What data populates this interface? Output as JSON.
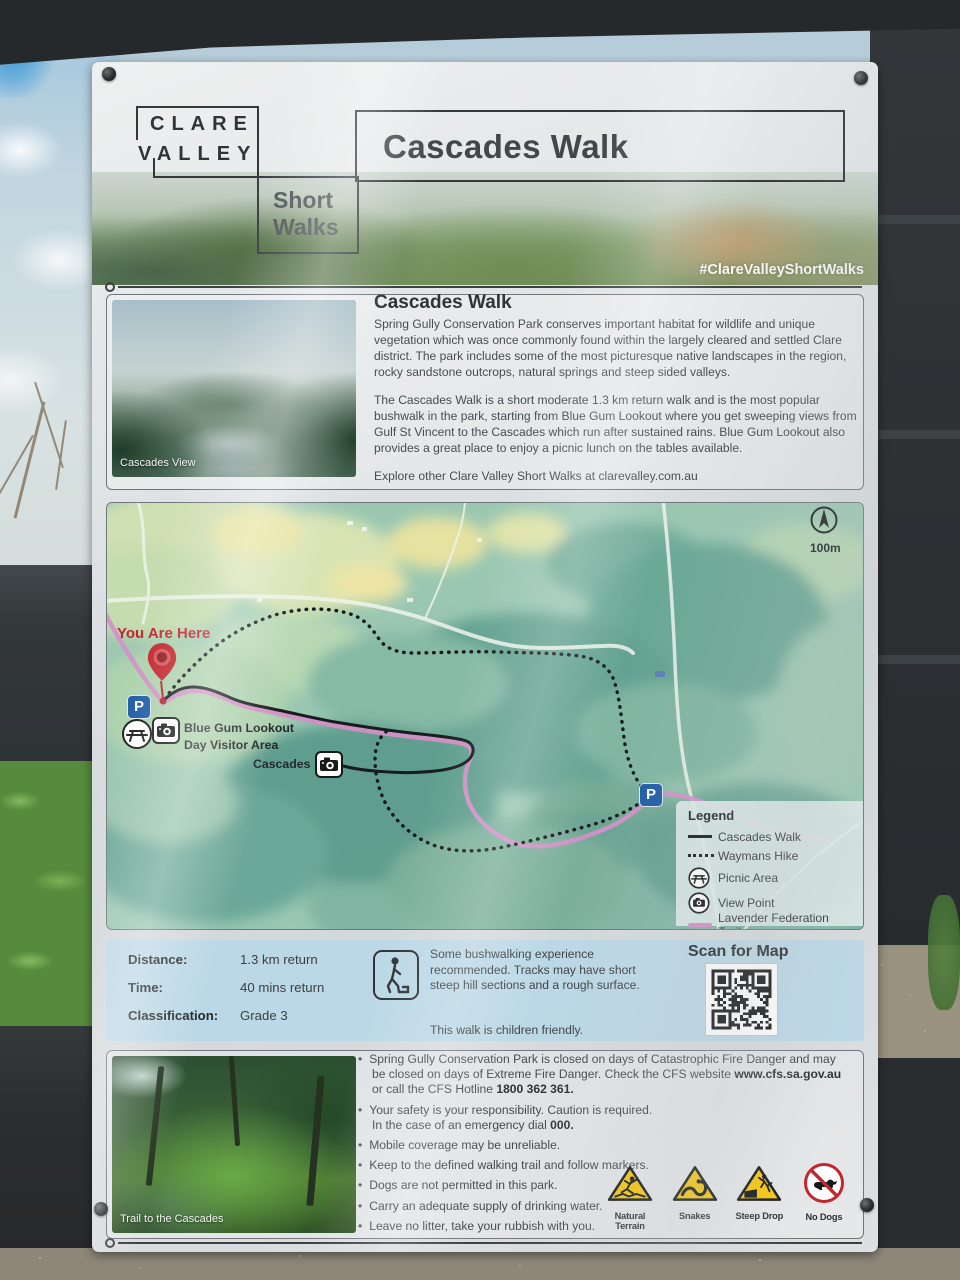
{
  "sign": {
    "brand": {
      "top": "CLARE",
      "bottom": "VALLEY"
    },
    "series": {
      "line1": "Short",
      "line2": "Walks"
    },
    "title": "Cascades Walk",
    "hashtag": "#ClareValleyShortWalks"
  },
  "about": {
    "heading": "Cascades Walk",
    "p1": "Spring Gully Conservation Park conserves important habitat for wildlife and unique vegetation which was once commonly found within the largely cleared and settled Clare district. The park includes some of the most picturesque native landscapes in the region, rocky sandstone outcrops, natural springs and steep sided valleys.",
    "p2": "The Cascades Walk is a short moderate 1.3 km return walk and is the most popular bushwalk in the park, starting from Blue Gum Lookout where you get sweeping views from Gulf St Vincent to the Cascades which run after sustained rains. Blue Gum Lookout also provides a great place to enjoy a picnic lunch on the tables available.",
    "p3": "Explore other Clare Valley Short Walks at clarevalley.com.au",
    "photo_caption": "Cascades View"
  },
  "map": {
    "you_are_here": "You Are Here",
    "scale_label": "100m",
    "parking_label": "P",
    "poi_blue_gum_line1": "Blue Gum Lookout",
    "poi_blue_gum_line2": "Day Visitor Area",
    "poi_cascades": "Cascades",
    "legend": {
      "title": "Legend",
      "items": [
        "Cascades Walk",
        "Waymans Hike",
        "Picnic Area",
        "View Point",
        "Lavender Federation Trail"
      ]
    }
  },
  "facts": {
    "rows": [
      {
        "label": "Distance:",
        "value": "1.3 km return"
      },
      {
        "label": "Time:",
        "value": "40 mins return"
      },
      {
        "label": "Classification:",
        "value": "Grade 3"
      }
    ],
    "note": "Some bushwalking experience recommended. Tracks may have short steep hill sections and a rough surface.",
    "note2": "This walk is children friendly.",
    "scan_heading": "Scan for Map"
  },
  "safety": {
    "photo_caption": "Trail to the Cascades",
    "bullets": [
      {
        "t1": "Spring Gully Conservation Park is closed on days of Catastrophic Fire Danger and may be closed on days of Extreme Fire Danger. Check the CFS website ",
        "b1": "www.cfs.sa.gov.au",
        "t2": " or call the CFS Hotline ",
        "b2": "1800 362 361."
      },
      {
        "t1": "Your safety is your responsibility. Caution is required.\nIn the case of an emergency dial ",
        "b1": "000."
      },
      {
        "t1": "Mobile coverage may be unreliable."
      },
      {
        "t1": "Keep to the defined walking trail and follow markers."
      },
      {
        "t1": "Dogs are not permitted in this park."
      },
      {
        "t1": "Carry an adequate supply of drinking water."
      },
      {
        "t1": "Leave no litter, take your rubbish with you."
      }
    ],
    "icon_labels": [
      "Natural Terrain",
      "Snakes",
      "Steep Drop",
      "No Dogs"
    ]
  },
  "colors": {
    "accent_red": "#c0272d",
    "parking_blue": "#1d5ba6",
    "trail_pink": "#d48fc7",
    "warning_yellow": "#f6c60e",
    "band_blue": "#bcd8e6",
    "legend_bg": "#dfeaea"
  }
}
